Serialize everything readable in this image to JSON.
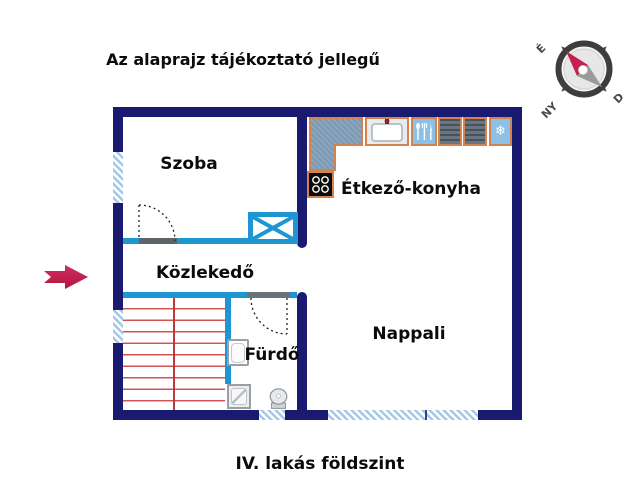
{
  "header": {
    "title": "Az alaprajz tájékoztató jellegű"
  },
  "footer": {
    "caption": "IV. lakás földszint"
  },
  "rooms": {
    "szoba": "Szoba",
    "etkezo_konyha": "Étkező-konyha",
    "kozlekedo": "Közlekedő",
    "nappali": "Nappali",
    "furdo": "Fürdő"
  },
  "compass": {
    "north_label": "É",
    "west_label": "NY",
    "south_label": "D"
  },
  "kitchen": {
    "freezer_glyph": "❄"
  },
  "colors": {
    "exterior_wall": "#1a1a70",
    "interior_wall": "#1e96d2",
    "window_hatch": "#a4c9e6",
    "stair_lines": "#c03a3a",
    "counter_border": "#d2834e",
    "appliance_fill": "#8cc0e6",
    "entrance_arrow": "#c5204e",
    "compass_needle": "#c5204e",
    "door_sill": "#5c6468"
  }
}
